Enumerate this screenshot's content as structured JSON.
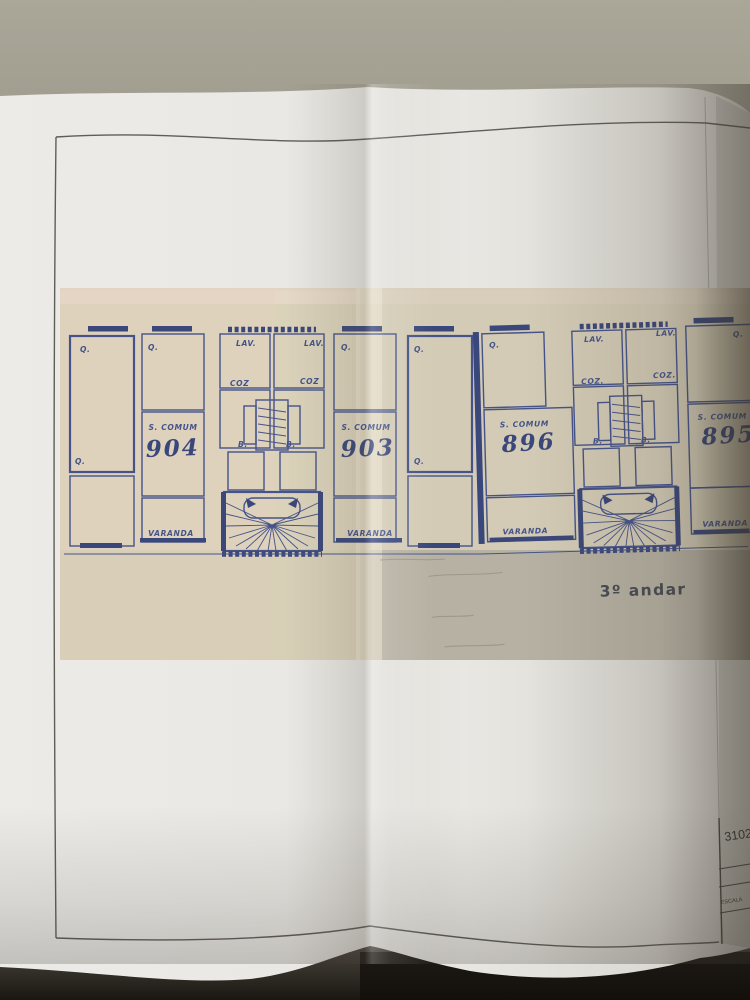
{
  "titleblock": {
    "drawing_number": "3102",
    "scale_label": "ESCALA"
  },
  "plan": {
    "floor_label": "3º andar",
    "units": [
      {
        "number": "904"
      },
      {
        "number": "903"
      },
      {
        "number": "896"
      },
      {
        "number": "895"
      }
    ],
    "rooms": {
      "bedroom": "Q.",
      "living": "S. COMUM",
      "kitchen": "COZ",
      "kitchen_alt": "COZ.",
      "laundry": "LAV.",
      "bathroom": "B.",
      "balcony": "VARANDA"
    },
    "colors": {
      "ink": "#45538a",
      "ink_dark": "#3a477a",
      "scan_paper": "#dbd2ba",
      "floor_label_color": "#474b52"
    }
  }
}
